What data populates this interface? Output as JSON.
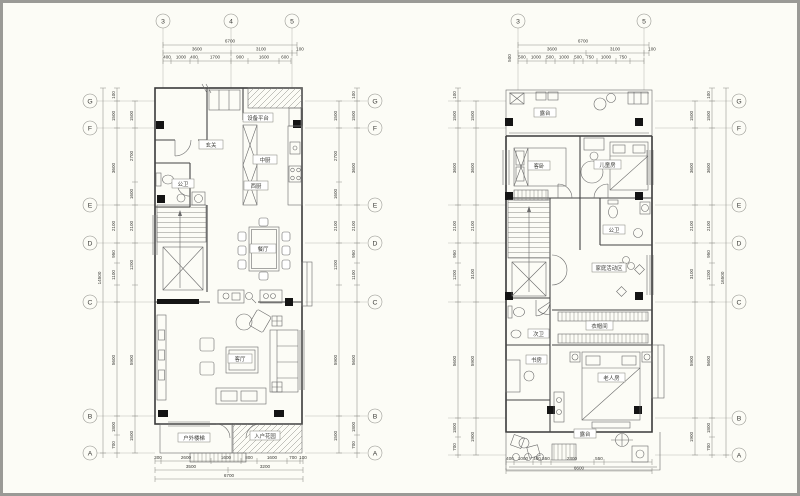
{
  "L": {
    "cols": [
      "3",
      "4",
      "5"
    ],
    "rows": [
      "G",
      "F",
      "E",
      "D",
      "C",
      "B",
      "A"
    ],
    "top": {
      "total": "6700",
      "s1": "3600",
      "s2": "3100",
      "s3": "100",
      "sub": [
        "400",
        "1000",
        "400",
        "1700",
        "900",
        "1600",
        "600"
      ]
    },
    "side": {
      "total": "14500",
      "outer": [
        "100",
        "1500",
        "3600",
        "2100",
        "950",
        "1100",
        "5600",
        "1800",
        "700"
      ],
      "inner": [
        "1500",
        "2700",
        "1600",
        "2100",
        "1200",
        "5900",
        "1500"
      ]
    },
    "bottom": {
      "total": "6700",
      "s1": "3500",
      "s2": "3200",
      "sub": [
        "300",
        "2600",
        "1600",
        "800",
        "1600",
        "700",
        "100"
      ]
    },
    "rooms": {
      "equip": "设备平台",
      "entry": "玄关",
      "bath": "公卫",
      "kcn": "中厨",
      "kw": "西厨",
      "dining": "餐厅",
      "living": "客厅",
      "ostairs": "户外楼梯",
      "garden": "入户花园"
    }
  },
  "R": {
    "cols": [
      "3",
      "5"
    ],
    "rows": [
      "G",
      "F",
      "E",
      "D",
      "C",
      "B",
      "A"
    ],
    "top": {
      "total": "6700",
      "s1": "3600",
      "s2": "3100",
      "s3": "100",
      "edge": "500",
      "sub": [
        "500",
        "1000",
        "500",
        "1000",
        "500",
        "750",
        "1000",
        "750"
      ]
    },
    "side": {
      "total": "16500",
      "outer": [
        "100",
        "1500",
        "3600",
        "2100",
        "950",
        "1200",
        "5600",
        "1800",
        "700"
      ],
      "inner": [
        "1500",
        "3600",
        "2100",
        "3100",
        "5900",
        "1900"
      ]
    },
    "bottom": {
      "total": "6600",
      "sub": [
        "400",
        "1000",
        "400",
        "550",
        "2300",
        "550"
      ]
    },
    "rooms": {
      "terr1": "露台",
      "bed": "客卧",
      "kids": "儿童房",
      "bath": "公卫",
      "family": "家庭活动区",
      "bath2": "次卫",
      "study": "书房",
      "closet": "衣帽间",
      "master": "老人房",
      "terr2": "露台"
    }
  }
}
